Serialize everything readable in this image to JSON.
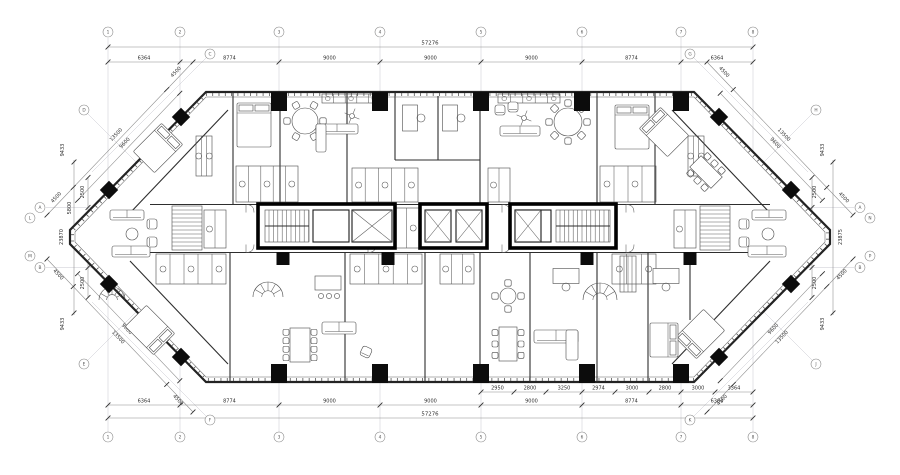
{
  "sheet": {
    "background": "#ffffff",
    "line_color": "#2e2e2e",
    "core_fill": "#000000",
    "grid_line_color": "#c7c7cf"
  },
  "dimensions": {
    "overall_width_top": "57276",
    "overall_width_bottom": "57276",
    "top_bays": [
      "6364",
      "8774",
      "9000",
      "9000",
      "9000",
      "8774",
      "6364"
    ],
    "bottom_bays": [
      "6364",
      "8774",
      "9000",
      "9000",
      "9000",
      "8774",
      "6364"
    ],
    "bottom_sub": [
      "2950",
      "2800",
      "3250",
      "2974",
      "3000",
      "2800",
      "3000",
      "3364"
    ],
    "left_total": "23870",
    "left_upper": "5800",
    "right_total": "23875",
    "mid_left": [
      "2500",
      "5000",
      "2500"
    ],
    "mid_right": [
      "2500",
      "5000",
      "2500"
    ],
    "corner_tl": [
      "4500",
      "13500",
      "4500",
      "9600",
      "9433"
    ],
    "corner_tr": [
      "4500",
      "13500",
      "4500",
      "9600",
      "9433"
    ],
    "corner_bl": [
      "4500",
      "13500",
      "4500",
      "9600",
      "9433"
    ],
    "corner_br": [
      "4500",
      "13500",
      "4500",
      "9600",
      "9433"
    ]
  },
  "grid": {
    "columns": [
      "1",
      "2",
      "3",
      "4",
      "5",
      "6",
      "7",
      "8"
    ],
    "rows_left": [
      "A",
      "B"
    ],
    "rows_right": [
      "A",
      "B"
    ],
    "diagonals": [
      "C",
      "D",
      "E",
      "F",
      "G",
      "H",
      "J",
      "K",
      "L",
      "M",
      "N",
      "P"
    ]
  }
}
